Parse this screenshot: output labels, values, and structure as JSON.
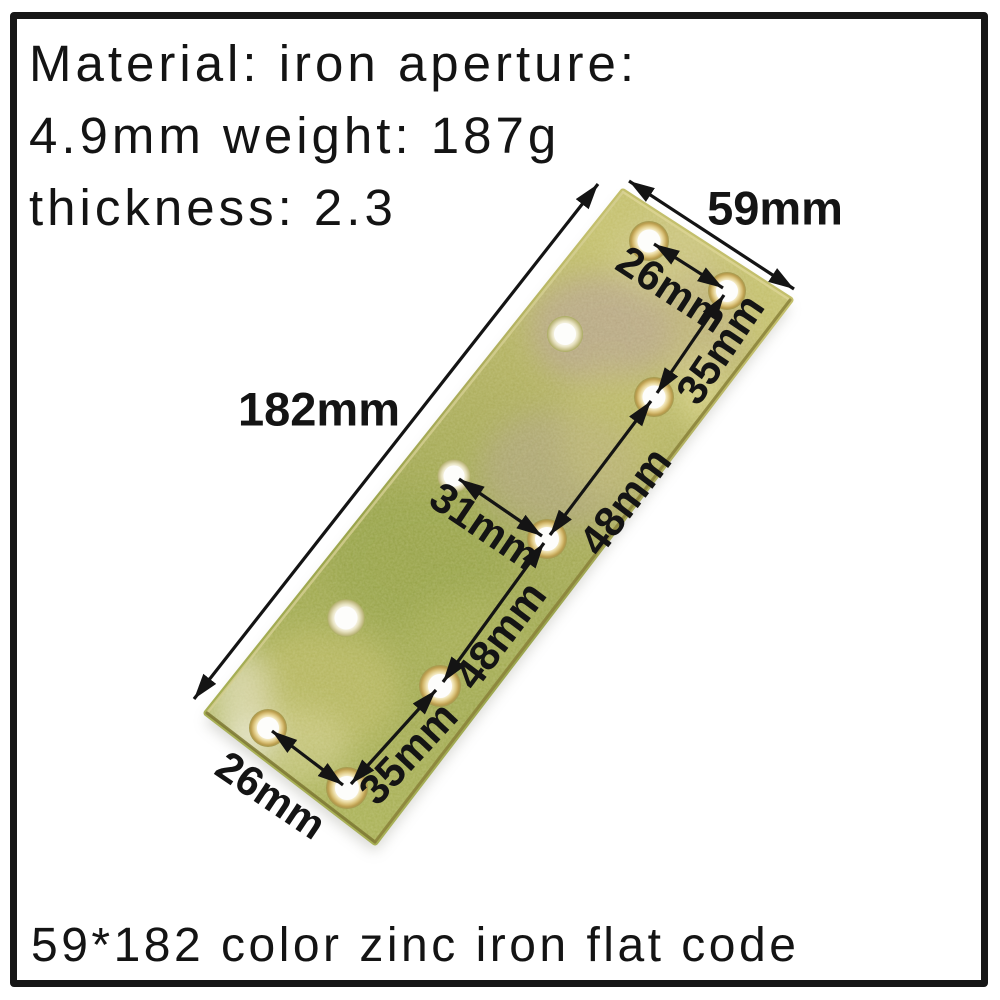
{
  "product_info": {
    "lines": [
      "Material: iron aperture:",
      "4.9mm weight: 187g",
      "thickness: 2.3"
    ]
  },
  "caption": "59*182 color zinc iron flat code",
  "diagram": {
    "dimensions": {
      "plate_width": "59mm",
      "plate_length": "182mm",
      "top_hole_diagonal": "26mm",
      "top_hole_spacing": "35mm",
      "upper_hole_spacing": "48mm",
      "middle_hole_diagonal": "31mm",
      "lower_hole_spacing": "48mm",
      "bottom_hole_spacing": "35mm",
      "bottom_hole_diagonal": "26mm"
    },
    "hole_count": 10,
    "colors": {
      "plate_base": "#a3ab52",
      "plate_light": "#c9c47a",
      "plate_mottle": "#b2a18e",
      "hole_ring": "#c9ab55",
      "annotation": "#141414",
      "frame_border": "#161616",
      "background": "#ffffff"
    }
  }
}
